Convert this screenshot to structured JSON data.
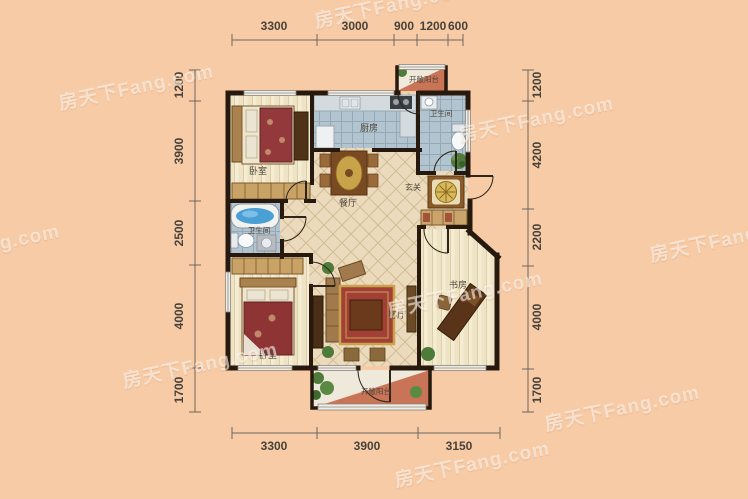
{
  "watermark": {
    "text": "房天下Fang.com"
  },
  "dimensions": {
    "top": [
      "3300",
      "3000",
      "900",
      "1200",
      "600"
    ],
    "bottom": [
      "3300",
      "3900",
      "3150"
    ],
    "left": [
      "1200",
      "3900",
      "2500",
      "4000",
      "1700"
    ],
    "right": [
      "1200",
      "4200",
      "2200",
      "4000",
      "1700"
    ]
  },
  "rooms": {
    "bedroom_top": "卧室",
    "kitchen": "厨房",
    "bathroom_top": "卫生间",
    "dining": "餐厅",
    "foyer": "玄关",
    "bathroom_mid": "卫生间",
    "bedroom_bottom": "卧室",
    "living": "客厅",
    "study": "书房",
    "balcony_top": "开敞阳台",
    "balcony_bottom": "开敞阳台"
  },
  "colors": {
    "background": "#f7cba6",
    "wall": "#27190d",
    "wood_floor": "#f4ecd3",
    "tile_floor": "#b2c4cf",
    "hall_floor": "#ebdbbc",
    "balcony_floor": "#c97457"
  }
}
